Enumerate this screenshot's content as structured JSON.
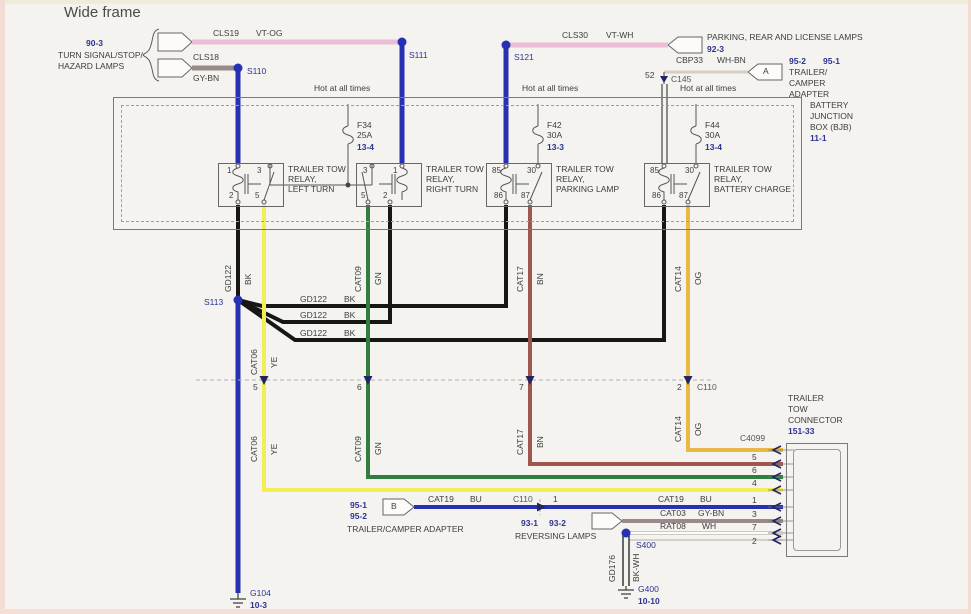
{
  "title": "Wide frame",
  "top": {
    "turn_ref": "90-3",
    "turn_l1": "TURN SIGNAL/STOP/",
    "turn_l2": "HAZARD LAMPS",
    "cls19": "CLS19",
    "cls19_color": "VT-OG",
    "cls18": "CLS18",
    "cls18_color": "GY-BN",
    "s110": "S110",
    "s111": "S111",
    "s121": "S121",
    "cls30": "CLS30",
    "cls30_color": "VT-WH",
    "parking_label": "PARKING, REAR AND LICENSE LAMPS",
    "parking_ref": "92-3",
    "cbp33": "CBP33",
    "cbp33_color": "WH-BN",
    "conn_a": "A",
    "adapter_ref2": "95-2",
    "adapter_ref1": "95-1",
    "adapter_l1": "TRAILER/",
    "adapter_l2": "CAMPER",
    "adapter_l3": "ADAPTER",
    "pin52": "52",
    "c145": "C145",
    "hot": "Hot at all times"
  },
  "bjb": {
    "l1": "BATTERY",
    "l2": "JUNCTION",
    "l3": "BOX (BJB)",
    "ref": "11-1",
    "fuses": [
      {
        "name": "F34",
        "amps": "25A",
        "ref": "13-4"
      },
      {
        "name": "F42",
        "amps": "30A",
        "ref": "13-3"
      },
      {
        "name": "F44",
        "amps": "30A",
        "ref": "13-4"
      }
    ],
    "relays": [
      {
        "l1": "TRAILER TOW",
        "l2": "RELAY,",
        "l3": "LEFT TURN",
        "tl": "1",
        "tr": "3",
        "bl": "2",
        "br": "5"
      },
      {
        "l1": "TRAILER TOW",
        "l2": "RELAY,",
        "l3": "RIGHT TURN",
        "tl": "3",
        "tr": "1",
        "bl": "5",
        "br": "2"
      },
      {
        "l1": "TRAILER TOW",
        "l2": "RELAY,",
        "l3": "PARKING LAMP",
        "tl": "85",
        "tr": "30",
        "bl": "86",
        "br": "87"
      },
      {
        "l1": "TRAILER TOW",
        "l2": "RELAY,",
        "l3": "BATTERY CHARGE",
        "tl": "85",
        "tr": "30",
        "bl": "86",
        "br": "87"
      }
    ]
  },
  "mid": {
    "s113": "S113",
    "gd122": "GD122",
    "bk": "BK",
    "cat06": "CAT06",
    "ye": "YE",
    "cat09": "CAT09",
    "gn": "GN",
    "cat17": "CAT17",
    "bn": "BN",
    "cat14": "CAT14",
    "og": "OG",
    "c110": "C110",
    "pin5": "5",
    "pin6": "6",
    "pin7": "7",
    "pin2": "2"
  },
  "conn": {
    "l1": "TRAILER",
    "l2": "TOW",
    "l3": "CONNECTOR",
    "ref": "151-33",
    "c4099": "C4099",
    "pin_bn": "5",
    "pin_gn": "6",
    "pin_ye": "4",
    "pin_bu": "1",
    "pin_gy": "3",
    "pin_wh": "7",
    "pin_last": "2"
  },
  "bottom": {
    "ref1": "95-1",
    "ref2": "95-2",
    "adapter": "TRAILER/CAMPER ADAPTER",
    "conn_b": "B",
    "cat19": "CAT19",
    "bu": "BU",
    "c110": "C110",
    "pin1": "1",
    "rev_ref1": "93-1",
    "rev_ref2": "93-2",
    "reversing": "REVERSING LAMPS",
    "cat03": "CAT03",
    "gy_bn": "GY-BN",
    "rat08": "RAT08",
    "wh": "WH",
    "s400": "S400",
    "gd176": "GD176",
    "bk_wh": "BK-WH",
    "g400": "G400",
    "g400_ref": "10-10",
    "g104": "G104",
    "g104_ref": "10-3"
  },
  "colors": {
    "splice_blue": "#2731b2",
    "wire_black": "#161616",
    "wire_yellow": "#f3ee52",
    "wire_green": "#2f7d3f",
    "wire_brown": "#9e564e",
    "wire_orange": "#eab945",
    "wire_blue": "#2731b2",
    "wire_pink": "#edbcd6",
    "wire_gray": "#9a8b8b",
    "wire_white": "#fcfcfa",
    "ref_navy": "#2d3390"
  }
}
